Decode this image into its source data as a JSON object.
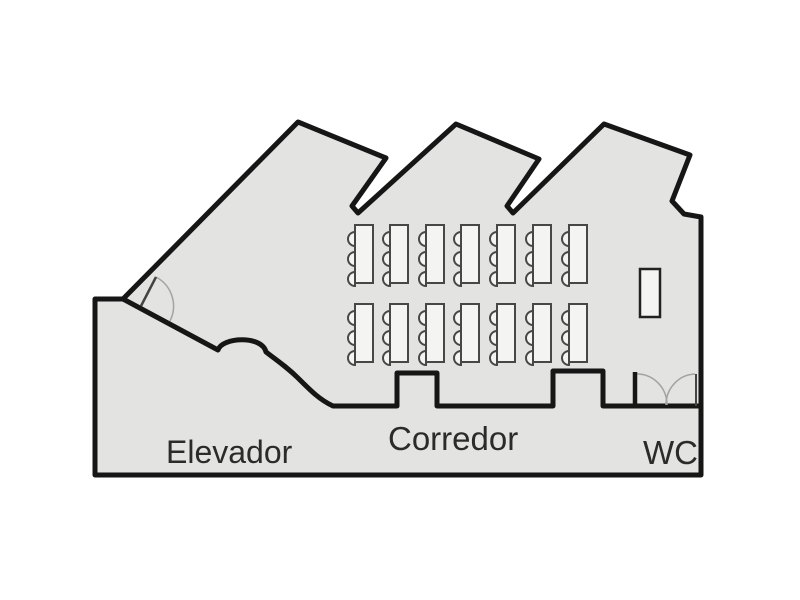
{
  "canvas": {
    "width": 800,
    "height": 600,
    "background": "#ffffff"
  },
  "colors": {
    "floor_fill": "#e3e3e1",
    "wall": "#161616",
    "furniture_stroke": "#474747",
    "furniture_fill": "#f4f4f2",
    "cabinet_stroke": "#222222",
    "door_leaf": "#444444",
    "door_arc": "#a3a39f",
    "label_text": "#2b2b2b"
  },
  "labels": [
    {
      "id": "elevador",
      "text": "Elevador",
      "x": 166,
      "y": 463,
      "size": 32
    },
    {
      "id": "corredor",
      "text": "Corredor",
      "x": 388,
      "y": 450,
      "size": 33
    },
    {
      "id": "wc",
      "text": "WC",
      "x": 643,
      "y": 464,
      "size": 33
    }
  ],
  "geometry": {
    "wall_thickness": 5,
    "interior_wall_thickness": 5,
    "outer_boundary": "95,475 95,299 123,299 298,122 386,158 352,206 358,213 456,124 539,159 507,206 513,213 604,124 690,155 672,201 684,214 701,217 701,475",
    "interior_wall_path": "M 123 299 L 218 350 C 222 337 262 335 266 352 C 278 361 288 368 299 379 C 311 391 320 400 333 406 L 397 406 L 397 373 L 437 373 L 437 406 L 553 406 L 553 371 L 603 371 L 603 406 L 701 406"
  },
  "furniture": {
    "tables": {
      "column_x": [
        355,
        390,
        426,
        461,
        497,
        533,
        569
      ],
      "row_y": [
        225,
        304
      ],
      "width": 18,
      "height": 58,
      "chair_offsets": [
        14,
        34,
        54
      ],
      "chair_radius": 7,
      "chairs_per_table": 3
    },
    "cabinet": {
      "x": 640,
      "y": 269,
      "width": 20,
      "height": 48
    }
  },
  "doors": {
    "single_door": {
      "leaf": {
        "x1": 141,
        "y1": 306,
        "x2": 156,
        "y2": 277
      },
      "arc_path": "M 156 277 A 33 33 0 0 1 170 321"
    },
    "double_door": {
      "jamb_left": {
        "x1": 635,
        "y1": 372,
        "x2": 635,
        "y2": 407,
        "width": 4.5
      },
      "jamb_right": {
        "x1": 696,
        "y1": 374,
        "x2": 696,
        "y2": 406,
        "width": 2
      },
      "arc_left_path": "M 637 374 A 30 31 0 0 1 667 405",
      "arc_right_path": "M 695 374 A 30 31 0 0 0 666 405"
    }
  }
}
